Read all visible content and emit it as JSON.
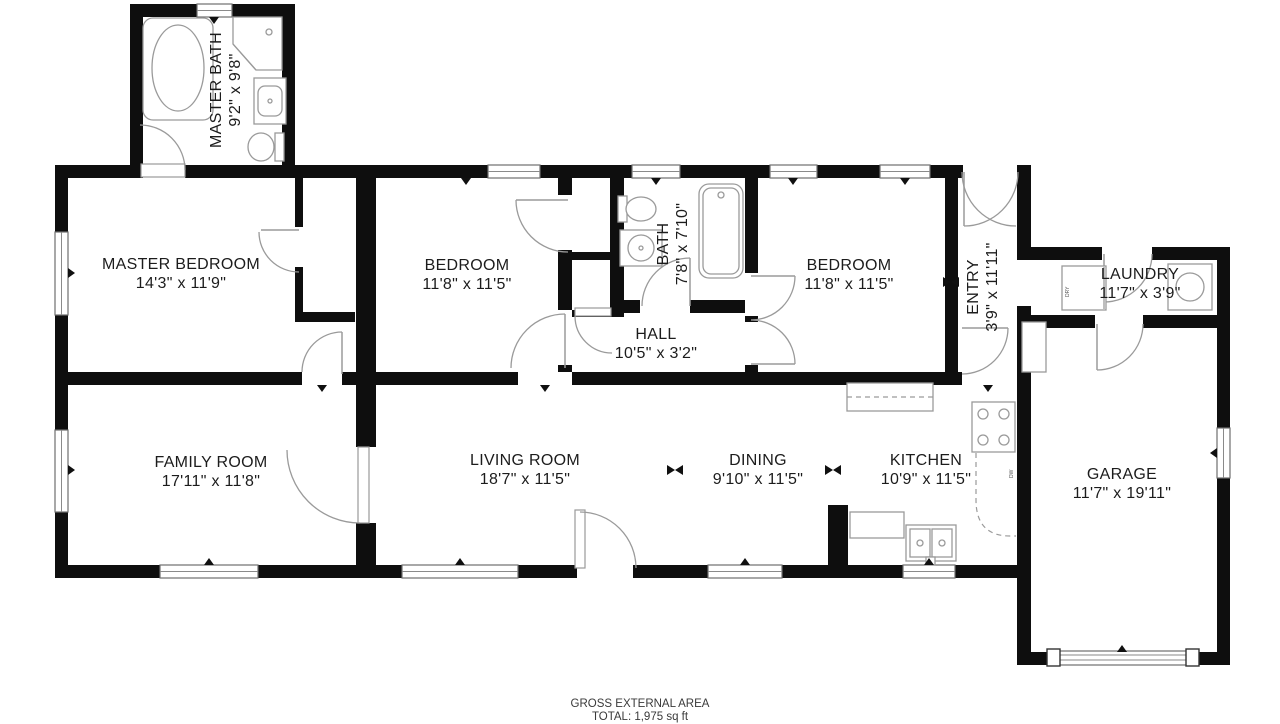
{
  "colors": {
    "wall": "#0e0e0e",
    "fixture_line": "#9a9a9a",
    "text": "#1c1c1c",
    "footer_text": "#3a3a3a"
  },
  "rooms": [
    {
      "id": "master-bath",
      "name": "MASTER BATH",
      "dims": "9'2\" x 9'8\""
    },
    {
      "id": "master-bedroom",
      "name": "MASTER BEDROOM",
      "dims": "14'3\" x 11'9\""
    },
    {
      "id": "bedroom-left",
      "name": "BEDROOM",
      "dims": "11'8\" x 11'5\""
    },
    {
      "id": "bath",
      "name": "BATH",
      "dims": "7'8\" x 7'10\""
    },
    {
      "id": "hall",
      "name": "HALL",
      "dims": "10'5\" x 3'2\""
    },
    {
      "id": "bedroom-right",
      "name": "BEDROOM",
      "dims": "11'8\" x 11'5\""
    },
    {
      "id": "entry",
      "name": "ENTRY",
      "dims": "3'9\" x 11'11\""
    },
    {
      "id": "laundry",
      "name": "LAUNDRY",
      "dims": "11'7\" x 3'9\""
    },
    {
      "id": "family-room",
      "name": "FAMILY ROOM",
      "dims": "17'11\" x 11'8\""
    },
    {
      "id": "living-room",
      "name": "LIVING ROOM",
      "dims": "18'7\" x 11'5\""
    },
    {
      "id": "dining",
      "name": "DINING",
      "dims": "9'10\" x 11'5\""
    },
    {
      "id": "kitchen",
      "name": "KITCHEN",
      "dims": "10'9\" x 11'5\""
    },
    {
      "id": "garage",
      "name": "GARAGE",
      "dims": "11'7\" x 19'11\""
    }
  ],
  "appliances": {
    "dryer_label": "DRY",
    "dishwasher_label": "DW"
  },
  "footer": {
    "line1": "GROSS EXTERNAL AREA",
    "line2": "TOTAL: 1,975 sq ft"
  }
}
